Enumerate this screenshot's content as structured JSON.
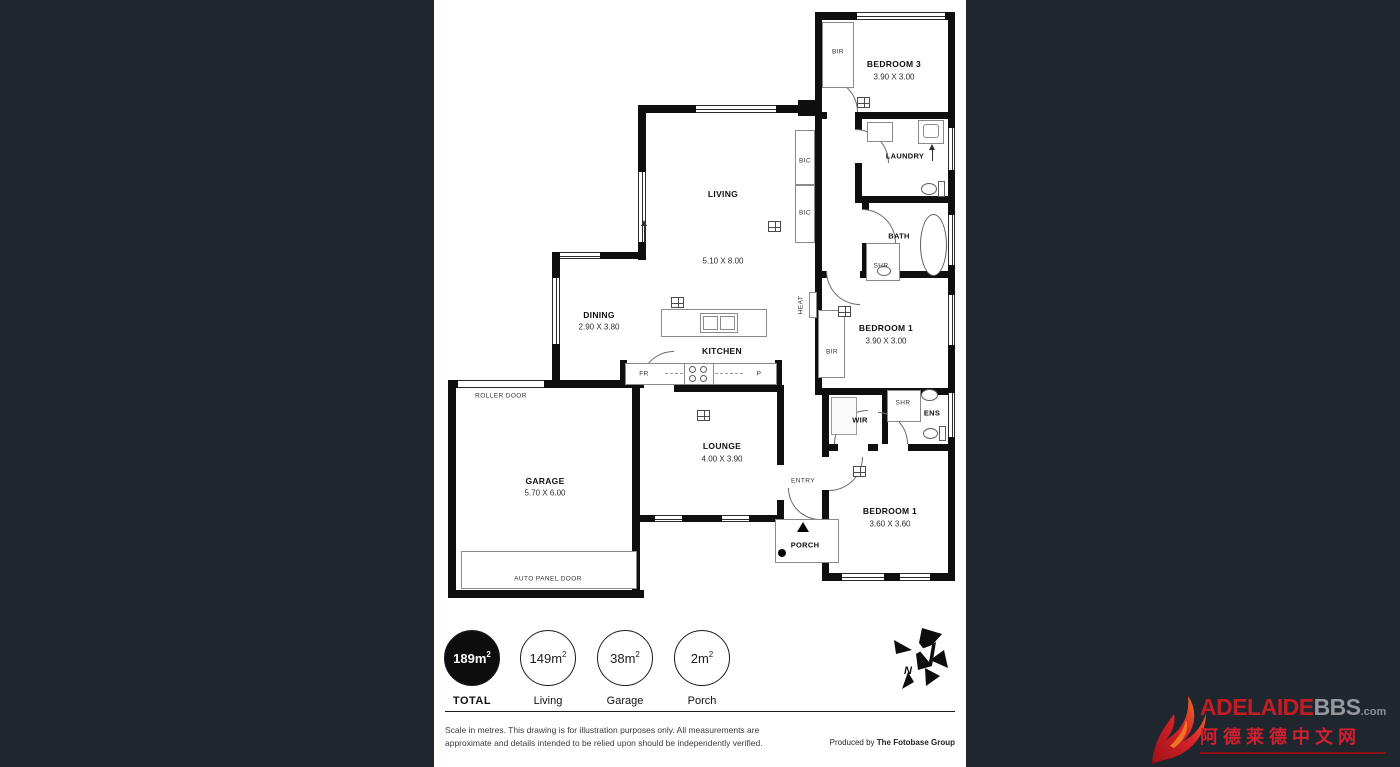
{
  "colors": {
    "page_bg": "#20262e",
    "wall": "#0f0f0f",
    "brand_red": "#c01d25",
    "brand_gray": "#94979b"
  },
  "plan": {
    "rooms": {
      "living": {
        "name": "LIVING",
        "dims": "5.10 X 8.00"
      },
      "dining": {
        "name": "DINING",
        "dims": "2.90 X 3.80"
      },
      "kitchen": {
        "name": "KITCHEN"
      },
      "lounge": {
        "name": "LOUNGE",
        "dims": "4.00 X 3.90"
      },
      "garage": {
        "name": "GARAGE",
        "dims": "5.70 X 6.00"
      },
      "bedroom3": {
        "name": "BEDROOM 3",
        "dims": "3.90 X 3.00"
      },
      "bedroom1_upper": {
        "name": "BEDROOM 1",
        "dims": "3.90 X 3.00"
      },
      "bedroom1_lower": {
        "name": "BEDROOM 1",
        "dims": "3.60 X 3.60"
      },
      "laundry": {
        "name": "LAUNDRY"
      },
      "bath": {
        "name": "BATH"
      },
      "wir": {
        "name": "WIR"
      },
      "ens": {
        "name": "ENS"
      },
      "entry": {
        "name": "ENTRY"
      },
      "porch": {
        "name": "PORCH"
      }
    },
    "fixtures": {
      "bir_bedroom3": "BIR",
      "bic_upper": "BIC",
      "bic_lower": "BIC",
      "bir_bedroom1": "BIR",
      "shr_bath": "SHR",
      "shr_ens": "SHR",
      "heat": "HEAT",
      "fridge": "FR",
      "pantry": "P"
    },
    "doors": {
      "roller": "ROLLER DOOR",
      "auto_panel": "AUTO PANEL DOOR"
    }
  },
  "compass": {
    "north": "N"
  },
  "legend": {
    "sup": "2",
    "total": {
      "value": "189m",
      "label": "TOTAL"
    },
    "living": {
      "value": "149m",
      "label": "Living"
    },
    "garage": {
      "value": "38m",
      "label": "Garage"
    },
    "porch": {
      "value": "2m",
      "label": "Porch"
    }
  },
  "footer": {
    "line1": "Scale in metres. This drawing is for illustration purposes only. All measurements are",
    "line2": "approximate and details intended to be relied upon should be independently verified.",
    "produced_by": "Produced by ",
    "producer": "The Fotobase Group"
  },
  "branding": {
    "name": "ADELAIDE",
    "bbs": "BBS",
    "tld": ".com",
    "chinese": "阿德莱德中文网"
  }
}
